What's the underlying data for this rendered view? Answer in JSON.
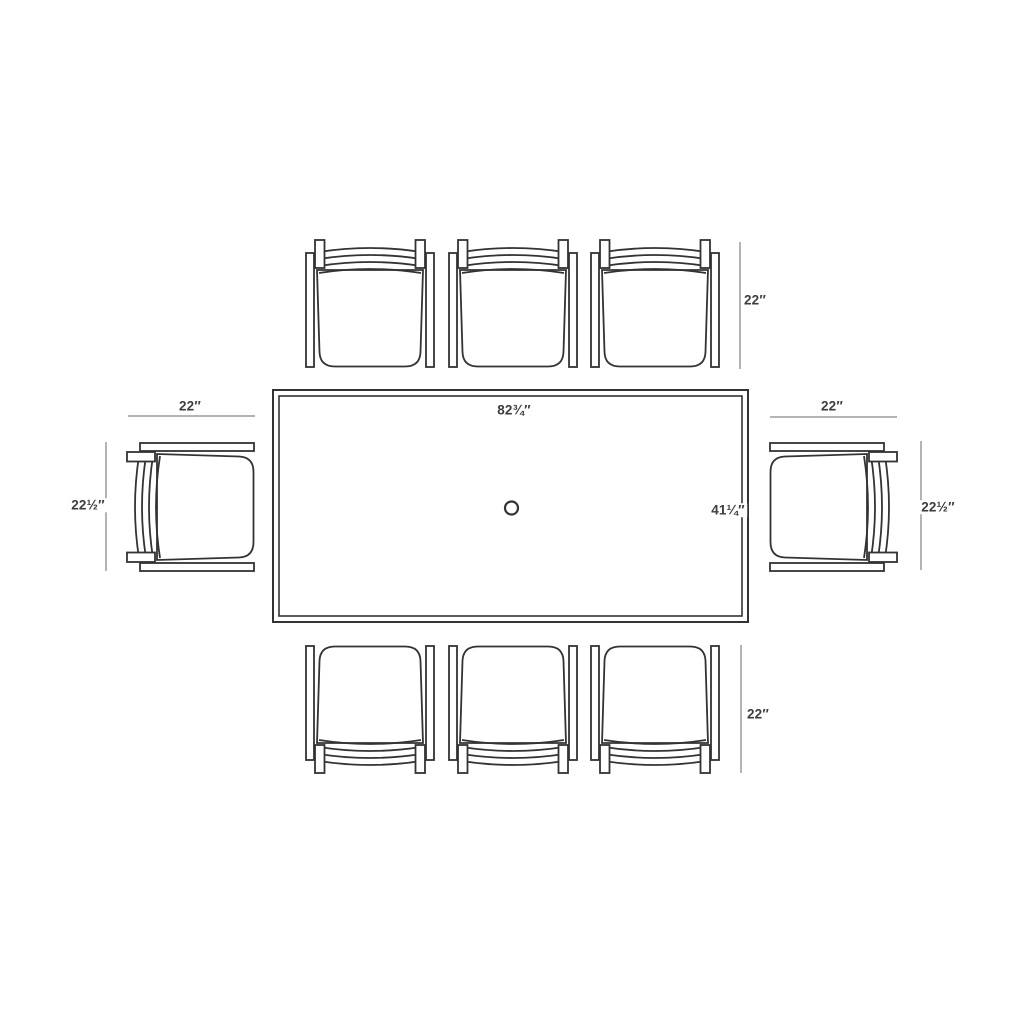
{
  "diagram": {
    "view": "top-view floor plan of rectangular dining table with 8 chairs",
    "chair_count": "8",
    "table_count": "1"
  },
  "dimensions": {
    "table_length": "82¾″",
    "table_width": "41¼″",
    "top_chairs_depth": "22″",
    "bottom_chairs_depth": "22″",
    "left_chair_width": "22″",
    "right_chair_width": "22″",
    "left_chair_depth": "22½″",
    "right_chair_depth": "22½″"
  },
  "colors": {
    "furniture_line": "#333333",
    "dimension_line": "#9b9b9b",
    "label_text": "#3d3d3d",
    "background": "#ffffff"
  }
}
